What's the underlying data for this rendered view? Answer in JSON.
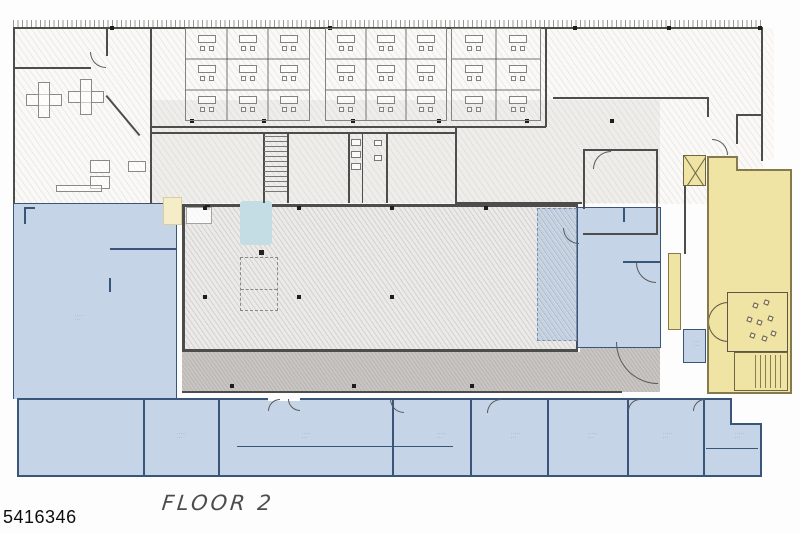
{
  "page": {
    "floor_label": "FLOOR 2",
    "listing_number": "5416346"
  },
  "palette": {
    "paper": "#fdfdfd",
    "wall": "#4d4d4b",
    "blue": "#c6d4e8",
    "blue_wall": "#3a557a",
    "yellow": "#efe4a4",
    "yellow_wall": "#857a4c",
    "gray_band": "#c8c5c2",
    "teal": "#c4dde4"
  },
  "annotations": {
    "room_label_smudge_line1": "·····",
    "room_label_smudge_line2": "···"
  }
}
